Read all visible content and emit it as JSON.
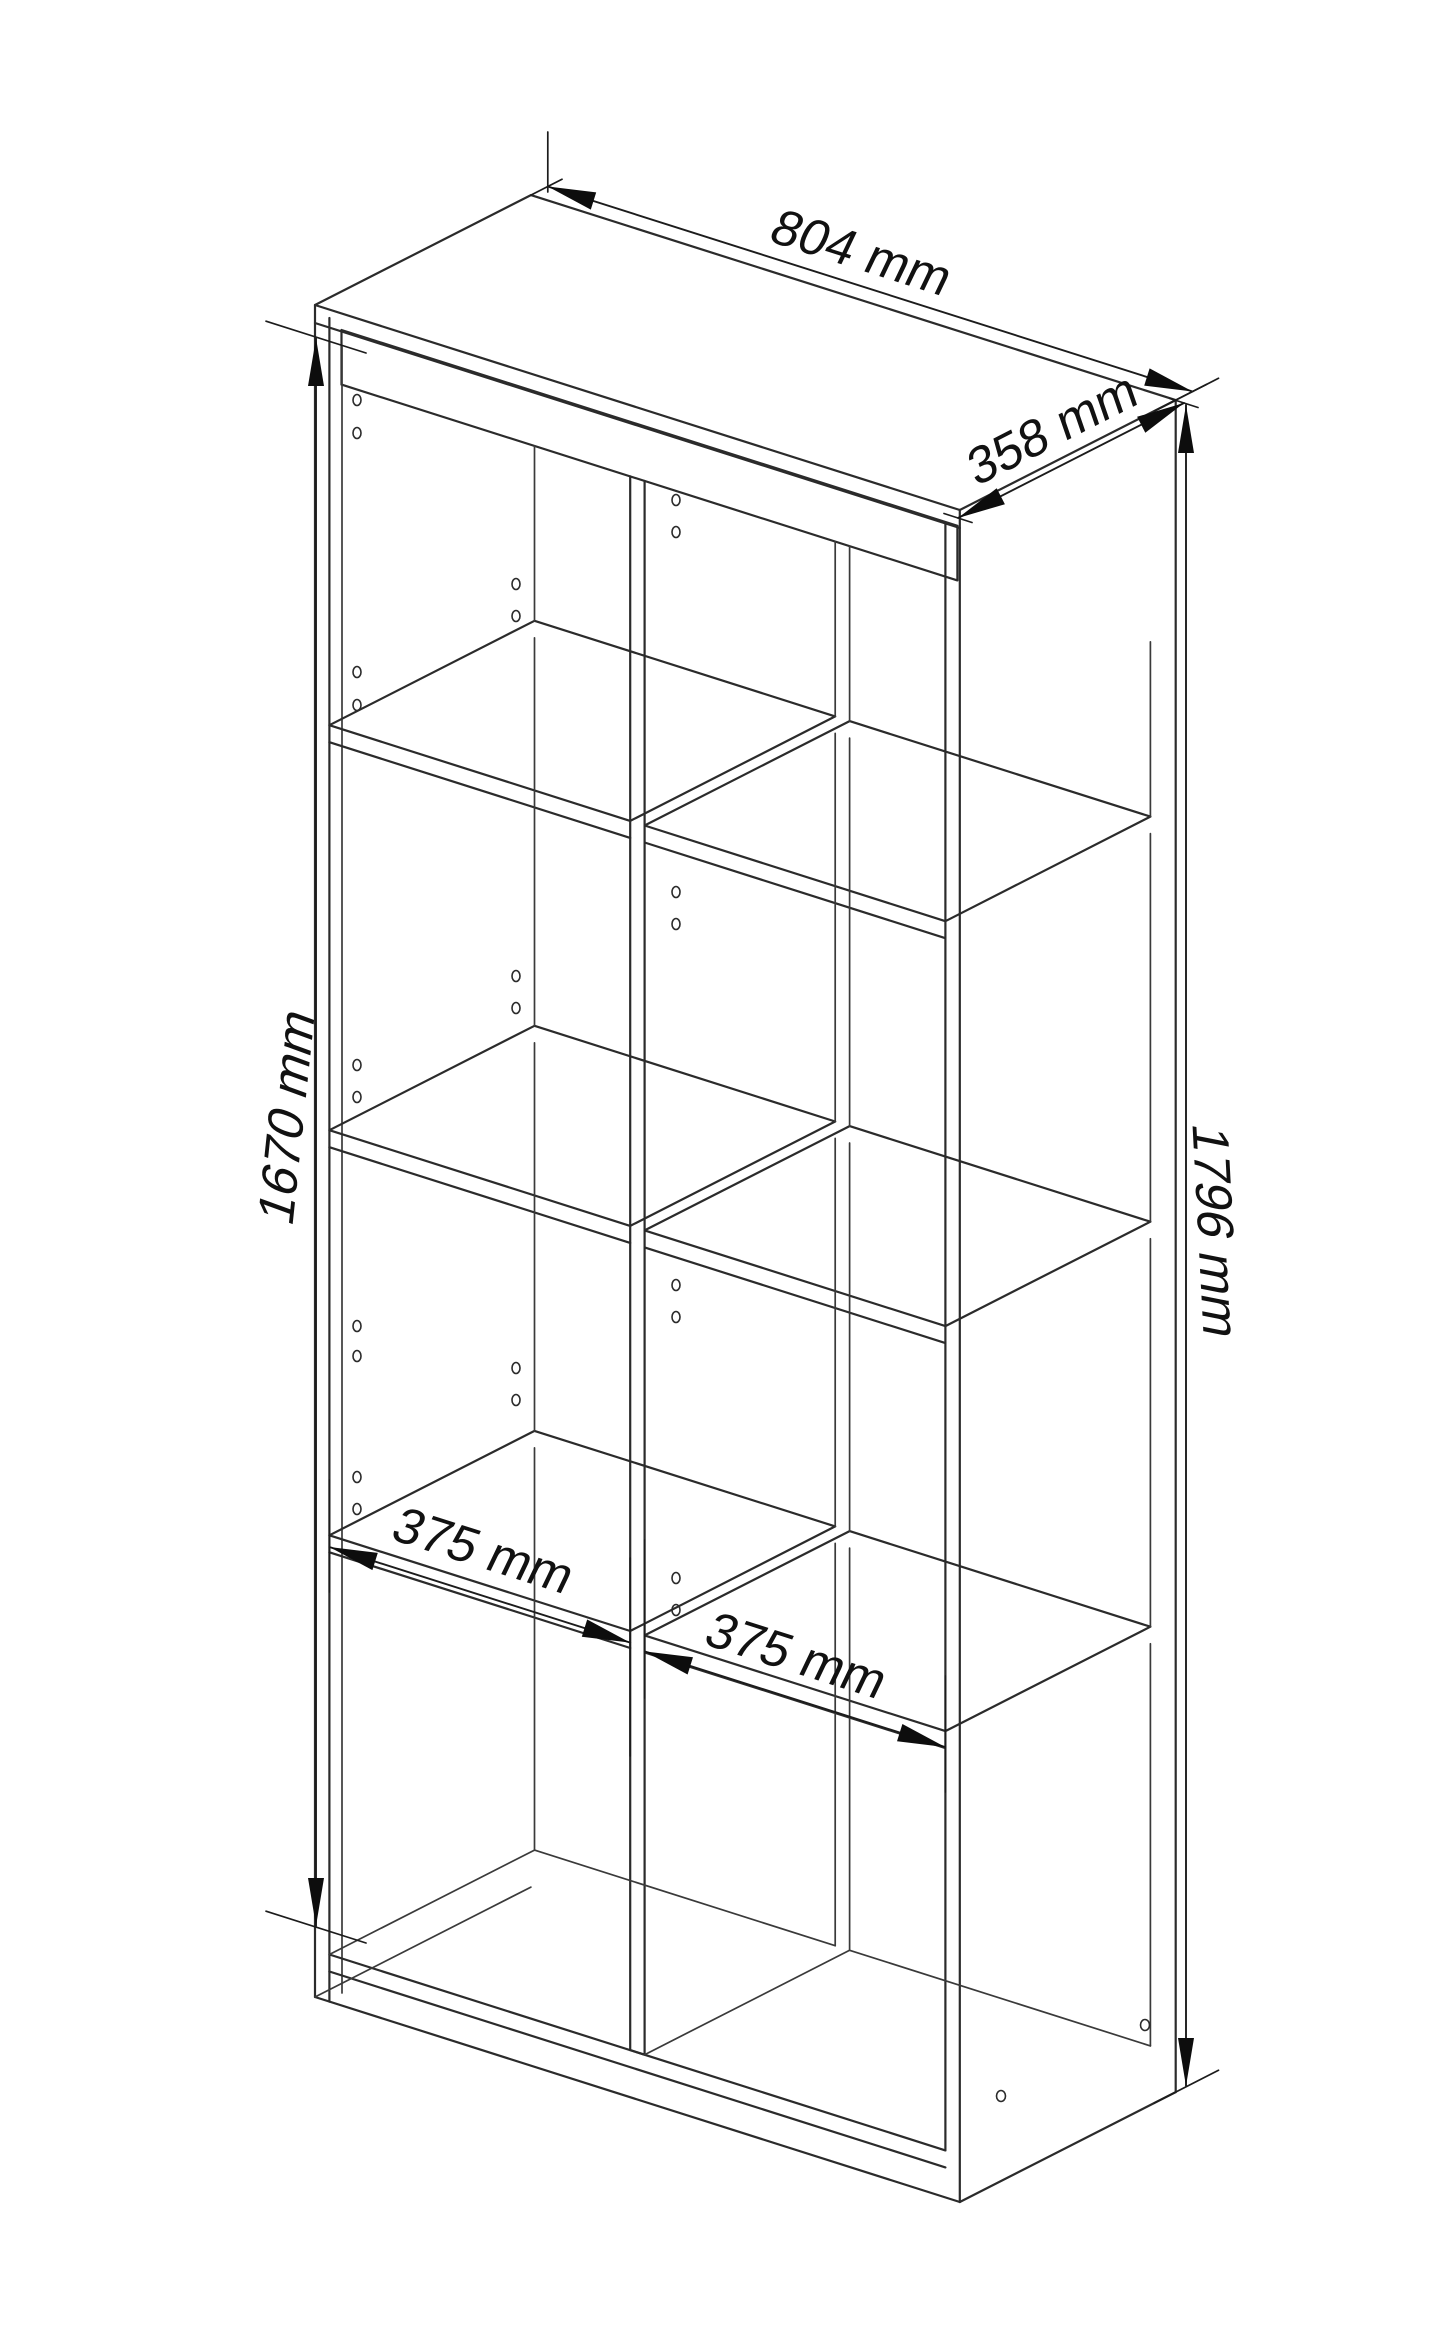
{
  "page": {
    "background": "#ffffff"
  },
  "drawing": {
    "type": "technical-dimension-drawing",
    "subject": "bookcase shelving unit, isometric line drawing",
    "line_color": "#2b2b2b",
    "text_color": "#111111",
    "dimensions": {
      "width": {
        "label": "804 mm",
        "value": 804,
        "unit": "mm",
        "measures": "overall width, along top back edge"
      },
      "depth": {
        "label": "358 mm",
        "value": 358,
        "unit": "mm",
        "measures": "overall depth, top right edge"
      },
      "left_height": {
        "label": "1670 mm",
        "value": 1670,
        "unit": "mm",
        "measures": "side panel height, left front edge"
      },
      "right_height": {
        "label": "1796 mm",
        "value": 1796,
        "unit": "mm",
        "measures": "overall height, right back edge"
      },
      "compartment_left": {
        "label": "375 mm",
        "value": 375,
        "unit": "mm",
        "measures": "left compartment inner width"
      },
      "compartment_right": {
        "label": "375 mm",
        "value": 375,
        "unit": "mm",
        "measures": "right compartment inner width"
      }
    },
    "structure": {
      "columns": 2,
      "rows": 4,
      "compartments": 8,
      "shelves_per_column": 3
    }
  }
}
